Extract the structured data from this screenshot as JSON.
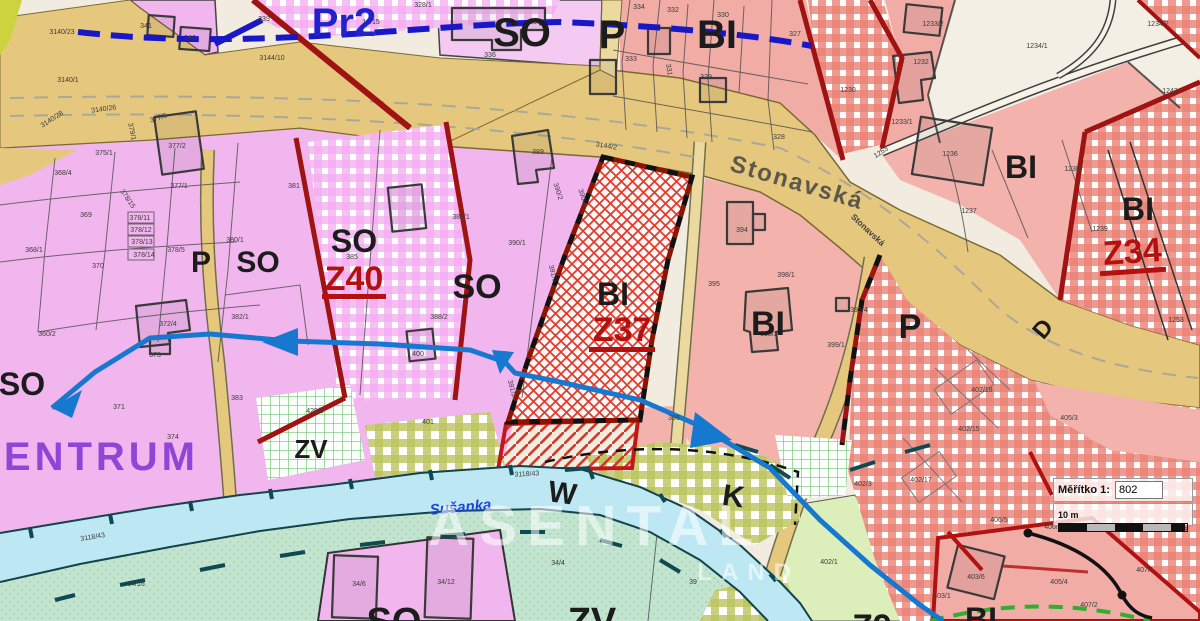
{
  "map": {
    "zone_labels": [
      {
        "t": "SO",
        "x": 522,
        "y": 46,
        "s": 40
      },
      {
        "t": "P",
        "x": 612,
        "y": 48,
        "s": 40
      },
      {
        "t": "BI",
        "x": 717,
        "y": 48,
        "s": 40
      },
      {
        "t": "P",
        "x": 201,
        "y": 272,
        "s": 30
      },
      {
        "t": "SO",
        "x": 258,
        "y": 272,
        "s": 30
      },
      {
        "t": "SO",
        "x": 354,
        "y": 252,
        "s": 32
      },
      {
        "t": "SO",
        "x": 477,
        "y": 298,
        "s": 34
      },
      {
        "t": "BI",
        "x": 613,
        "y": 305,
        "s": 32
      },
      {
        "t": "BI",
        "x": 768,
        "y": 335,
        "s": 34
      },
      {
        "t": "P",
        "x": 910,
        "y": 338,
        "s": 34
      },
      {
        "t": "BI",
        "x": 1021,
        "y": 178,
        "s": 32
      },
      {
        "t": "BI",
        "x": 1138,
        "y": 220,
        "s": 32
      },
      {
        "t": "SO",
        "x": 22,
        "y": 395,
        "s": 32
      },
      {
        "t": "ZV",
        "x": 311,
        "y": 458,
        "s": 26
      },
      {
        "t": "W",
        "x": 561,
        "y": 503,
        "s": 30,
        "r": 8
      },
      {
        "t": "K",
        "x": 732,
        "y": 506,
        "s": 30,
        "r": 8
      },
      {
        "t": "SO",
        "x": 394,
        "y": 634,
        "s": 38
      },
      {
        "t": "ZV",
        "x": 592,
        "y": 634,
        "s": 38
      },
      {
        "t": "BI",
        "x": 981,
        "y": 630,
        "s": 32
      },
      {
        "t": "Z9",
        "x": 872,
        "y": 638,
        "s": 34
      },
      {
        "t": "D",
        "x": 1049,
        "y": 334,
        "s": 24,
        "r": -50
      },
      {
        "t": "Pr2",
        "x": 344,
        "y": 36,
        "s": 40,
        "c": "#2222cc"
      },
      {
        "t": "CENTRUM",
        "x": 85,
        "y": 470,
        "s": 40,
        "c": "#8f46d6",
        "ls": 4
      }
    ],
    "zone_code_labels": [
      {
        "t": "Z40",
        "x": 354,
        "y": 290,
        "s": 34
      },
      {
        "t": "Z37",
        "x": 622,
        "y": 341,
        "s": 34
      },
      {
        "t": "Z34",
        "x": 1133,
        "y": 263,
        "s": 34,
        "r": -4
      }
    ],
    "street_labels": [
      {
        "t": "Stonavská",
        "x": 795,
        "y": 190,
        "s": 24,
        "r": 16.5,
        "c": "#5c584a",
        "ls": 2
      },
      {
        "t": "Stonavská",
        "x": 866,
        "y": 232,
        "s": 8.5,
        "r": 43,
        "c": "#3f3f3f"
      }
    ],
    "stream_labels": [
      {
        "t": "Sušanka",
        "x": 461,
        "y": 512,
        "s": 15,
        "r": -5,
        "c": "#1f46d8",
        "i": 1
      }
    ],
    "parcel_labels": [
      {
        "t": "3140/23",
        "x": 62,
        "y": 34
      },
      {
        "t": "341",
        "x": 146,
        "y": 28
      },
      {
        "t": "340",
        "x": 190,
        "y": 40
      },
      {
        "t": "339",
        "x": 264,
        "y": 21
      },
      {
        "t": "328/1",
        "x": 423,
        "y": 7
      },
      {
        "t": "18/15",
        "x": 371,
        "y": 24
      },
      {
        "t": "3144/10",
        "x": 272,
        "y": 60
      },
      {
        "t": "3140/1",
        "x": 68,
        "y": 82
      },
      {
        "t": "3140/26",
        "x": 104,
        "y": 111,
        "r": -8
      },
      {
        "t": "3140/28",
        "x": 53,
        "y": 121,
        "r": -33
      },
      {
        "t": "377/5",
        "x": 159,
        "y": 120,
        "r": -18
      },
      {
        "t": "377/2",
        "x": 177,
        "y": 148
      },
      {
        "t": "375/1",
        "x": 104,
        "y": 155
      },
      {
        "t": "379/1",
        "x": 130,
        "y": 132,
        "r": 78
      },
      {
        "t": "377/1",
        "x": 179,
        "y": 188
      },
      {
        "t": "368/4",
        "x": 63,
        "y": 175
      },
      {
        "t": "378/15",
        "x": 126,
        "y": 200,
        "r": 55
      },
      {
        "t": "378/11",
        "x": 140,
        "y": 220
      },
      {
        "t": "378/12",
        "x": 141,
        "y": 232
      },
      {
        "t": "378/13",
        "x": 142,
        "y": 244
      },
      {
        "t": "378/14",
        "x": 144,
        "y": 257
      },
      {
        "t": "378/5",
        "x": 176,
        "y": 252
      },
      {
        "t": "380/1",
        "x": 235,
        "y": 242
      },
      {
        "t": "369",
        "x": 86,
        "y": 217
      },
      {
        "t": "368/1",
        "x": 34,
        "y": 252
      },
      {
        "t": "370",
        "x": 98,
        "y": 268
      },
      {
        "t": "360/2",
        "x": 47,
        "y": 336
      },
      {
        "t": "372/4",
        "x": 168,
        "y": 326
      },
      {
        "t": "373",
        "x": 155,
        "y": 357
      },
      {
        "t": "381",
        "x": 294,
        "y": 188
      },
      {
        "t": "382/1",
        "x": 240,
        "y": 319
      },
      {
        "t": "383",
        "x": 237,
        "y": 400
      },
      {
        "t": "371",
        "x": 119,
        "y": 409
      },
      {
        "t": "374",
        "x": 173,
        "y": 439
      },
      {
        "t": "420/9",
        "x": 315,
        "y": 413
      },
      {
        "t": "385",
        "x": 352,
        "y": 259
      },
      {
        "t": "388/1",
        "x": 461,
        "y": 219
      },
      {
        "t": "390/1",
        "x": 517,
        "y": 245
      },
      {
        "t": "388/2",
        "x": 439,
        "y": 319
      },
      {
        "t": "400",
        "x": 418,
        "y": 356
      },
      {
        "t": "391/2",
        "x": 510,
        "y": 389,
        "r": 75
      },
      {
        "t": "389",
        "x": 538,
        "y": 154
      },
      {
        "t": "390/2",
        "x": 556,
        "y": 192,
        "r": 72
      },
      {
        "t": "390/4",
        "x": 581,
        "y": 198,
        "r": 72
      },
      {
        "t": "391/3",
        "x": 551,
        "y": 274,
        "r": 75
      },
      {
        "t": "401",
        "x": 428,
        "y": 424
      },
      {
        "t": "34/16",
        "x": 136,
        "y": 586
      },
      {
        "t": "34/6",
        "x": 359,
        "y": 586
      },
      {
        "t": "34/12",
        "x": 446,
        "y": 584
      },
      {
        "t": "34/4",
        "x": 558,
        "y": 565
      },
      {
        "t": "39",
        "x": 693,
        "y": 584
      },
      {
        "t": "3118/43",
        "x": 93,
        "y": 539,
        "r": -9
      },
      {
        "t": "3118/43",
        "x": 527,
        "y": 476,
        "r": -3
      },
      {
        "t": "335",
        "x": 535,
        "y": 24
      },
      {
        "t": "336",
        "x": 490,
        "y": 57
      },
      {
        "t": "334",
        "x": 639,
        "y": 9
      },
      {
        "t": "332",
        "x": 673,
        "y": 12
      },
      {
        "t": "333",
        "x": 631,
        "y": 61
      },
      {
        "t": "331",
        "x": 667,
        "y": 70,
        "r": 80
      },
      {
        "t": "330",
        "x": 723,
        "y": 17
      },
      {
        "t": "329",
        "x": 706,
        "y": 79
      },
      {
        "t": "327",
        "x": 795,
        "y": 36
      },
      {
        "t": "328",
        "x": 779,
        "y": 139
      },
      {
        "t": "394",
        "x": 742,
        "y": 232
      },
      {
        "t": "395",
        "x": 714,
        "y": 286
      },
      {
        "t": "396",
        "x": 674,
        "y": 420
      },
      {
        "t": "398/1",
        "x": 786,
        "y": 277
      },
      {
        "t": "398/2",
        "x": 769,
        "y": 336
      },
      {
        "t": "399/1",
        "x": 836,
        "y": 347
      },
      {
        "t": "399/4",
        "x": 859,
        "y": 312
      },
      {
        "t": "3144/2",
        "x": 606,
        "y": 148,
        "r": 10
      },
      {
        "t": "1233/2",
        "x": 933,
        "y": 26
      },
      {
        "t": "1232",
        "x": 921,
        "y": 64
      },
      {
        "t": "1230",
        "x": 848,
        "y": 92
      },
      {
        "t": "1233/1",
        "x": 902,
        "y": 124
      },
      {
        "t": "1253",
        "x": 882,
        "y": 154,
        "r": -33
      },
      {
        "t": "1234/1",
        "x": 1037,
        "y": 48
      },
      {
        "t": "1234/2",
        "x": 1158,
        "y": 26
      },
      {
        "t": "1242",
        "x": 1170,
        "y": 93
      },
      {
        "t": "1236",
        "x": 950,
        "y": 156
      },
      {
        "t": "1237",
        "x": 969,
        "y": 213
      },
      {
        "t": "1238",
        "x": 1072,
        "y": 171
      },
      {
        "t": "1239",
        "x": 1100,
        "y": 231
      },
      {
        "t": "1253",
        "x": 1176,
        "y": 322
      },
      {
        "t": "402/18",
        "x": 982,
        "y": 392
      },
      {
        "t": "402/15",
        "x": 969,
        "y": 431
      },
      {
        "t": "402/17",
        "x": 921,
        "y": 482
      },
      {
        "t": "402/3",
        "x": 863,
        "y": 486
      },
      {
        "t": "405/3",
        "x": 1069,
        "y": 420
      },
      {
        "t": "402/1",
        "x": 829,
        "y": 564
      },
      {
        "t": "406/5",
        "x": 999,
        "y": 522
      },
      {
        "t": "406/6",
        "x": 1053,
        "y": 529
      },
      {
        "t": "403/6",
        "x": 976,
        "y": 579
      },
      {
        "t": "403/1",
        "x": 942,
        "y": 598
      },
      {
        "t": "405/4",
        "x": 1059,
        "y": 584
      },
      {
        "t": "407/1",
        "x": 1145,
        "y": 572
      },
      {
        "t": "407/2",
        "x": 1089,
        "y": 607
      },
      {
        "t": "408",
        "x": 1182,
        "y": 532
      }
    ],
    "colors": {
      "pink_so": "#f2b6ee",
      "salmon_bi": "#f1aca6",
      "cream": "#f4efe4",
      "road_tan": "#e6c77e",
      "red_border": "#a01313",
      "zone_code_red": "#b31010",
      "mint": "#c3e4cf",
      "light_green": "#dcefba",
      "channel_blue": "#bde8f3",
      "flow_blue": "#1778d0",
      "pr2_blue": "#2222cc",
      "centrum_purple": "#8f46d6"
    }
  },
  "watermark": {
    "line1": "ASENTAL",
    "line2": "LAND"
  },
  "scale_box": {
    "label": "Měřítko 1:",
    "value": "802",
    "bar_label": "10 m"
  }
}
